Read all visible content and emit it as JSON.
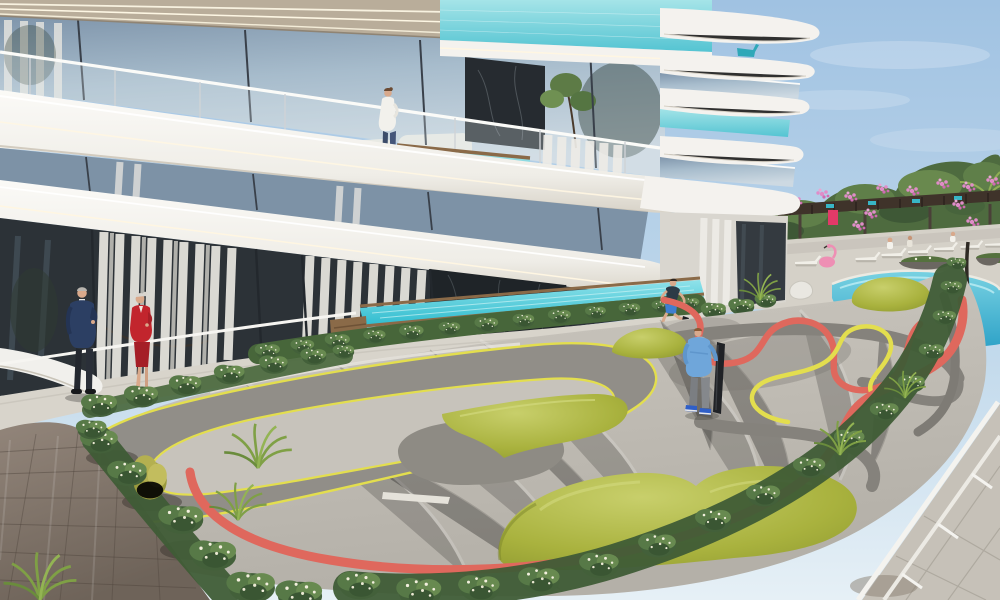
{
  "scene": {
    "title": "Sunny architectural rendering: modern residential building with curved white balconies and glass plunge pools, ground-level lap pool, resort pool with loungers and floats, pink-flowered pergola, and a grey concrete skate pump track with yellow lines, coral-red band and olive-green mounds",
    "sky": "clear light-blue sky with faint soft clouds on the right",
    "building": {
      "style": "curved white slab balconies, glass railings, LED strip lighting under slabs",
      "features": [
        "glass curtain-wall facade reflecting the sky",
        "turquoise mosaic glass-walled plunge pools on balconies",
        "beige soffit band with linear lights",
        "white sheer curtains behind ground-floor glazing",
        "dark marble feature wall panels",
        "rounded stacked balconies wrapping the right corner",
        "teal lounge chair on an upper corner balcony",
        "white sofa visible behind second-floor glass"
      ]
    },
    "amenities": {
      "lap_pool": "ground-level glass-edged turquoise lap pool with timber coping and timber steps",
      "resort_pool": "free-form turquoise pool with white sun loungers, bathers, a pink flamingo float, pink and yellow swim rings",
      "pergola": "dark timber pergola covered in pink flowering vines with a small magenta sign",
      "pump_track": "grey concrete pump track: left oval loop with yellow edge lines, right section with meandering coral-red and yellow lines, sculpted olive-green mounds, coral-red outer band",
      "landscape": [
        "white-flowering shrub beds along the track and lap pool",
        "ornamental palm grasses and a yellow-green bush",
        "brown stone paver plaza at lower left",
        "light pavers and white perimeter railing at lower right",
        "tree line behind the pool terrace"
      ]
    },
    "people": [
      {
        "id": "man-in-navy-suit",
        "where": "walkway lower left, grey hair, navy jacket, dark trousers, talking"
      },
      {
        "id": "woman-in-red-suit",
        "where": "walkway lower left, silver hair, red jacket and skirt, talking"
      },
      {
        "id": "woman-on-balcony",
        "where": "second-floor balcony beside the plunge pool, white top, blue jeans"
      },
      {
        "id": "boy-running",
        "where": "running beside the lap pool, dark tee, blue shorts"
      },
      {
        "id": "boy-with-skateboard",
        "where": "standing on the pump track, light-blue jacket with grey hood, grey pants, blue shoes, dark board held upright"
      }
    ]
  },
  "palette": {
    "sky_top": "#a6c6e4",
    "sky_horizon": "#e3eef6",
    "slab_white": "#f4f2ee",
    "soffit_beige": "#b9ad9a",
    "glass_high": "#c2d3e0",
    "glass_low": "#8ea6bc",
    "glass_dark": "#2c3237",
    "aqua_pool_glass": "#7fd6dc",
    "lap_pool_water": "#38c4d6",
    "resort_pool": "#3fb0d4",
    "concrete_plaza": "#c9c5bd",
    "track_grey": "#918e88",
    "line_yellow": "#e3de4e",
    "band_red": "#df685d",
    "mound_olive": "#a9b23e",
    "hedge_green": "#4f6e3c",
    "paver_brown": "#83776d",
    "deck_light": "#d5d1c8",
    "timber": "#8a6a48",
    "flower_pink": "#e08cc8"
  }
}
